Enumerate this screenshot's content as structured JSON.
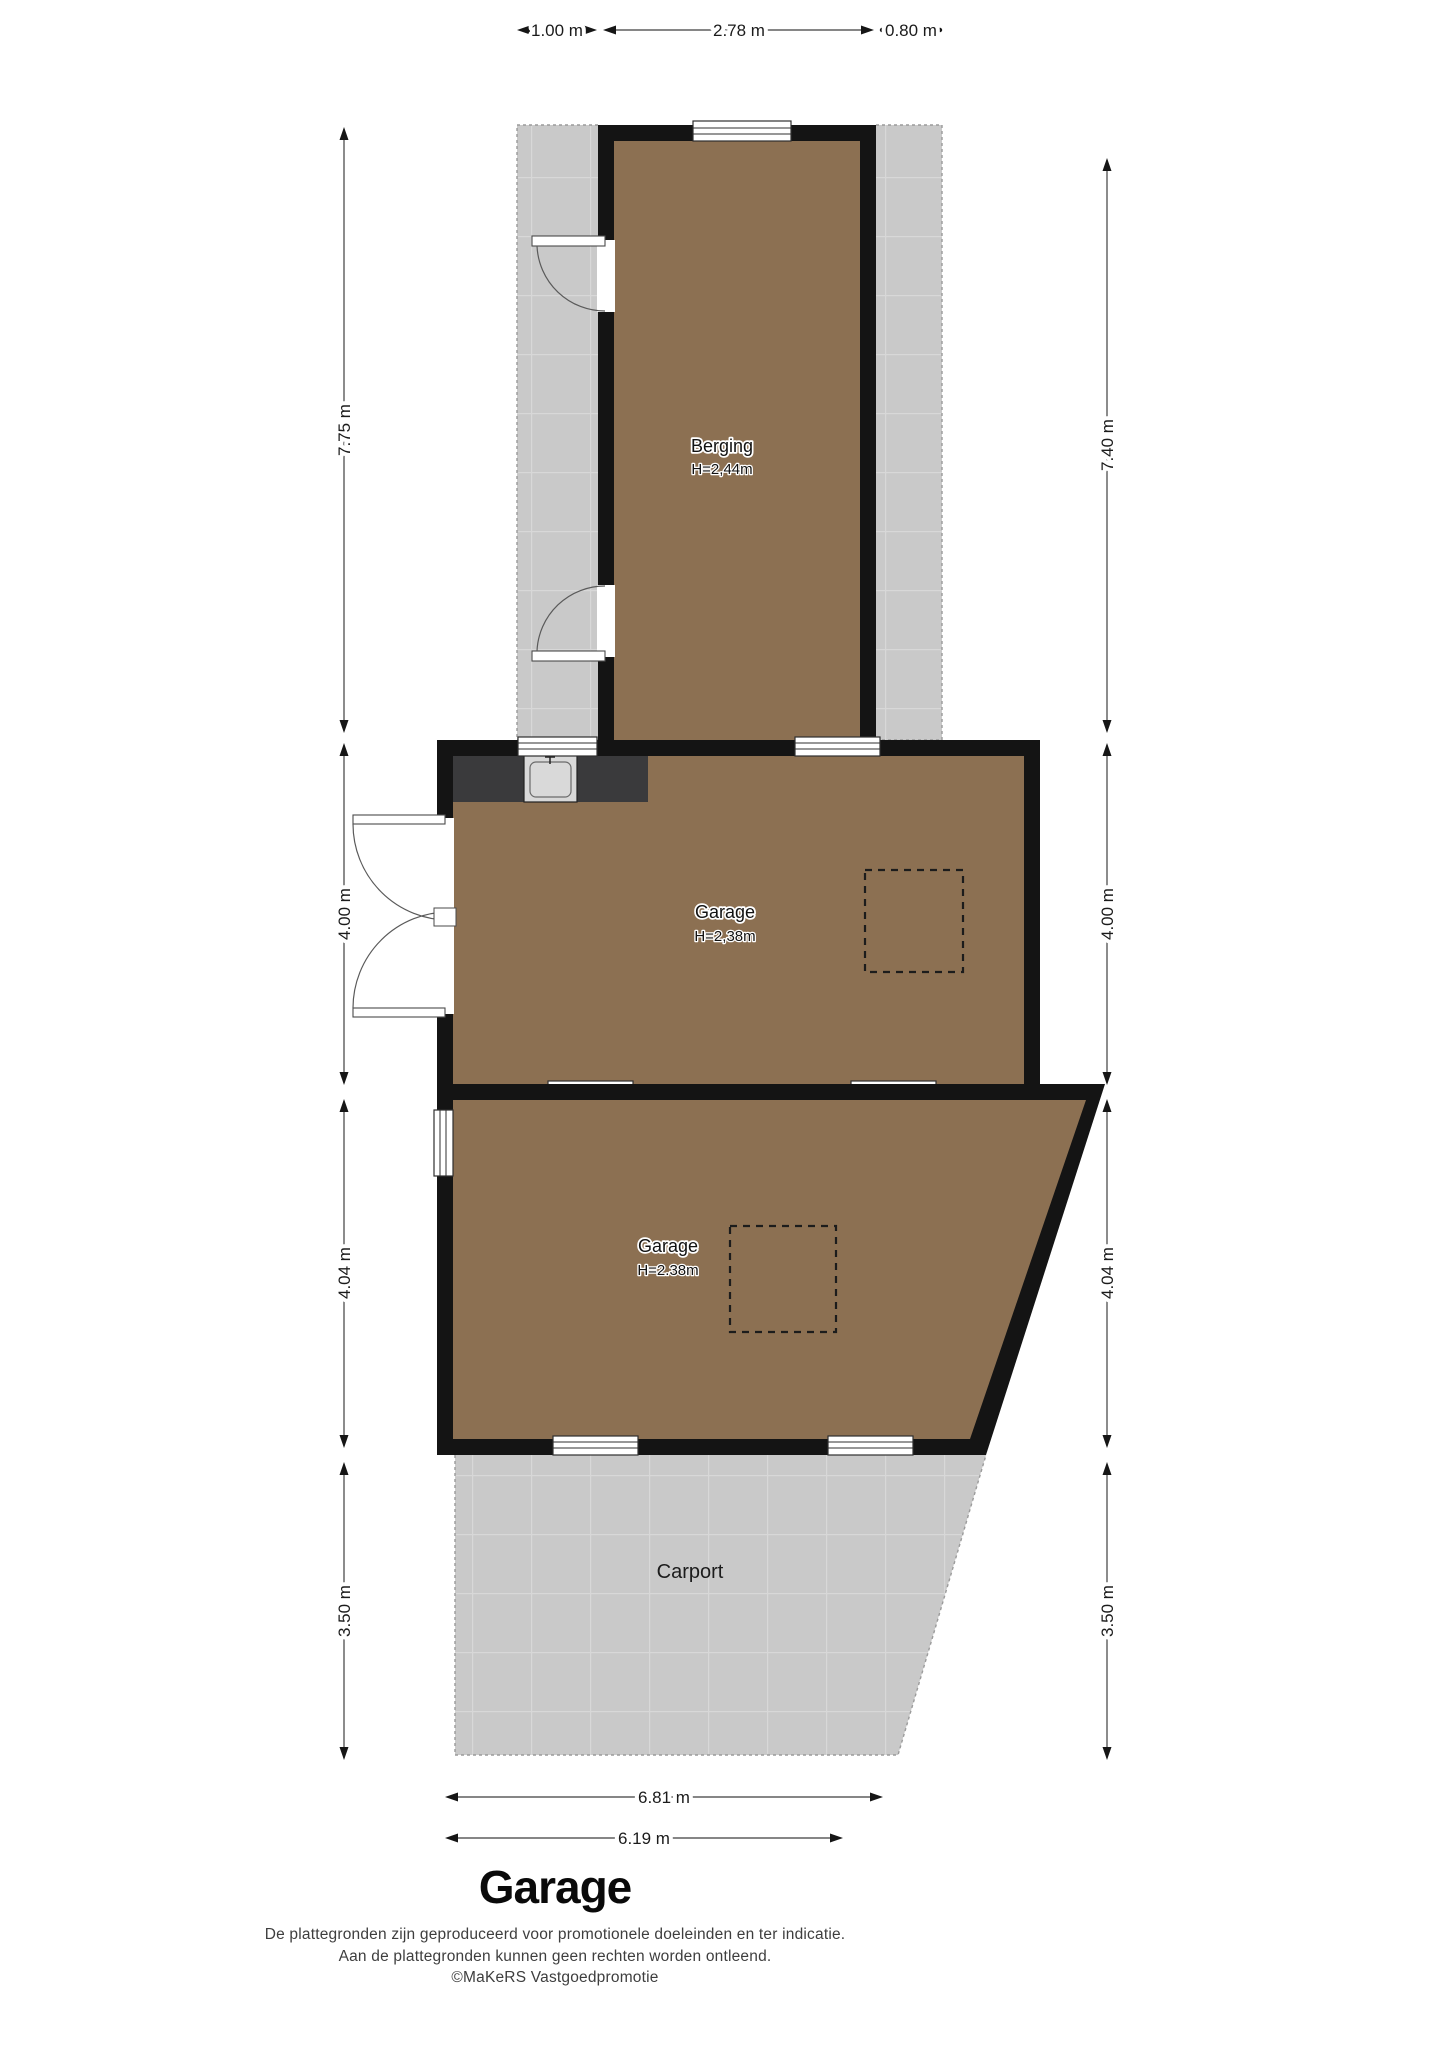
{
  "plan": {
    "rooms": {
      "berging": {
        "name": "Berging",
        "height": "H=2,44m"
      },
      "garage_1": {
        "name": "Garage",
        "height": "H=2,38m"
      },
      "garage_2": {
        "name": "Garage",
        "height": "H=2.38m"
      },
      "carport": {
        "name": "Carport"
      }
    },
    "dimensions": {
      "top": [
        "1.00 m",
        "2.78 m",
        "0.80 m"
      ],
      "left": [
        "7.75 m",
        "4.00 m",
        "4.04 m",
        "3.50 m"
      ],
      "right": [
        "7.40 m",
        "4.00 m",
        "4.04 m",
        "3.50 m"
      ],
      "bottom": [
        "6.81 m",
        "6.19 m"
      ]
    },
    "colors": {
      "floor": "#8c7052",
      "wall": "#141414",
      "paving": "#c9c9c9",
      "counter": "#3a3a3c"
    }
  },
  "footer": {
    "title": "Garage",
    "disclaimer_line1": "De plattegronden zijn geproduceerd voor promotionele doeleinden en ter indicatie.",
    "disclaimer_line2": "Aan de plattegronden kunnen geen rechten worden ontleend.",
    "disclaimer_line3": "©MaKeRS Vastgoedpromotie"
  }
}
